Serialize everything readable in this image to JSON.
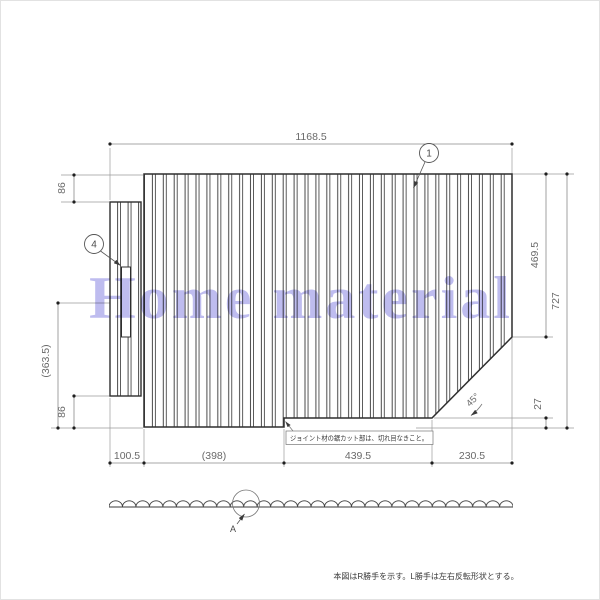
{
  "watermark": {
    "text": "Home material",
    "color": "#9390e4"
  },
  "drawing": {
    "balloon_1": "1",
    "balloon_4": "4",
    "detail_label": "A",
    "angle_label": "45°",
    "note_box": "ジョイント材の鋸カット部は、切れ目なきこと。",
    "footer_note": "本図はR勝手を示す。L勝手は左右反転形状とする。",
    "dimensions": {
      "top_width": "1168.5",
      "bottom": [
        "100.5",
        "(398)",
        "439.5",
        "230.5"
      ],
      "left_top_offset": "86",
      "left_mid": "(363.5)",
      "left_bottom_offset": "86",
      "right_upper": "469.5",
      "right_total": "727",
      "right_lower": "27"
    },
    "line_color": "#2f2f2f",
    "dim_color": "#6a6a6a"
  }
}
